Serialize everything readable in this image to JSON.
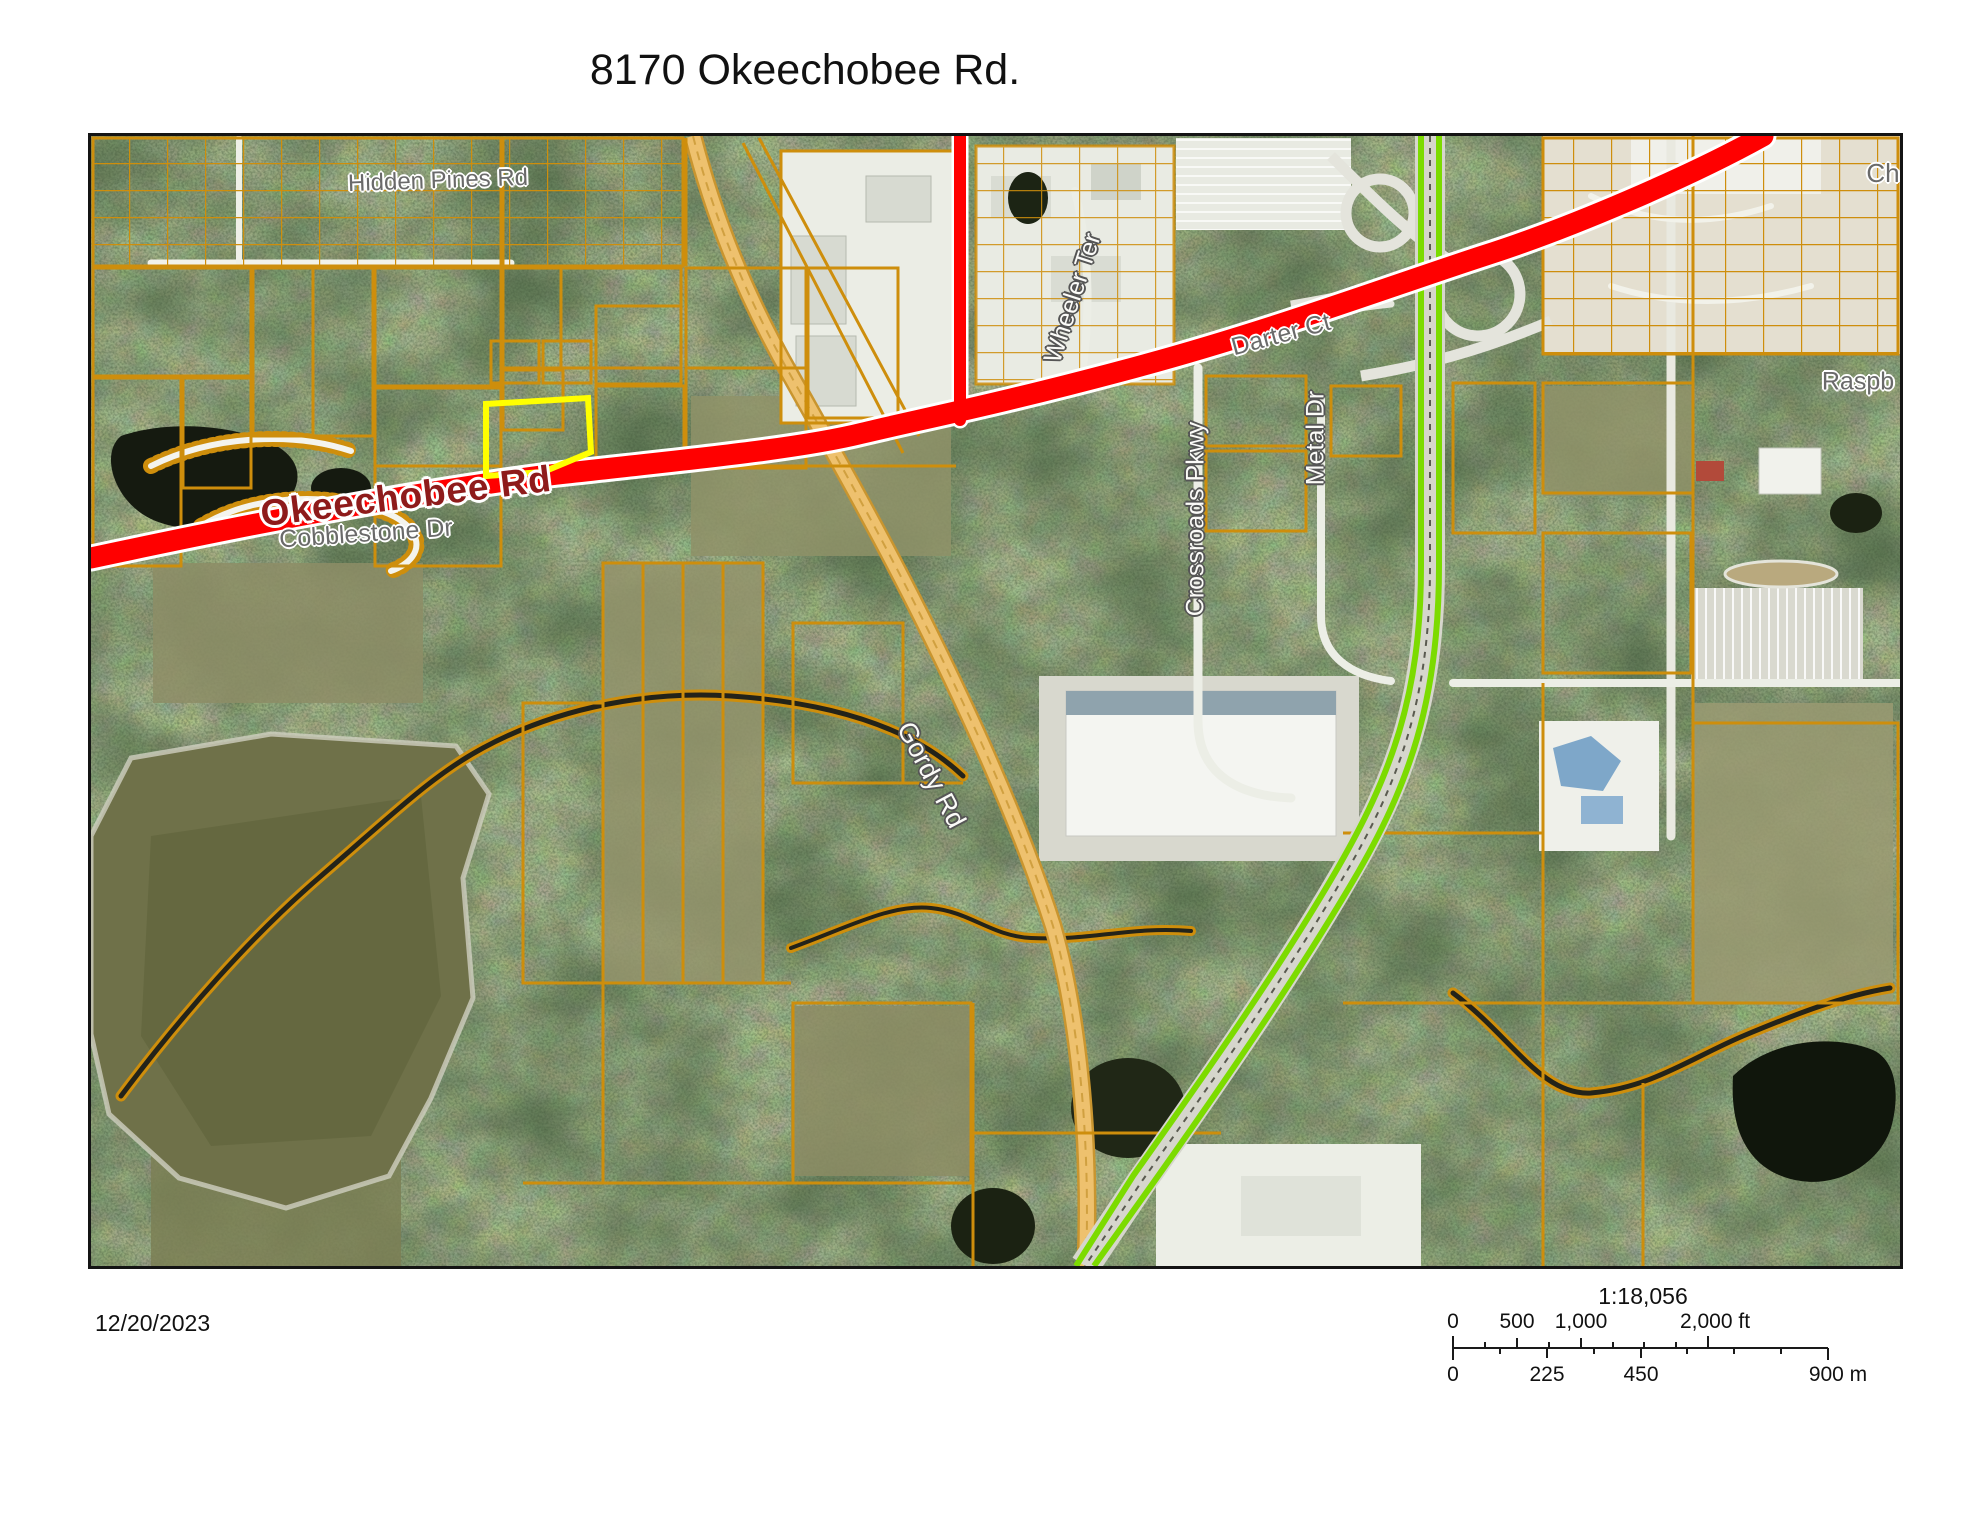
{
  "title": "8170 Okeechobee Rd.",
  "map": {
    "labels": {
      "hidden_pines": "Hidden Pines Rd",
      "okeechobee": "Okeechobee Rd",
      "cobblestone": "Cobblestone Dr",
      "wheeler": "Wheeler Ter",
      "darter": "Darter Ct",
      "crossroads": "Crossroads Pkwy",
      "metal": "Metal Dr",
      "gordy": "Gordy Rd",
      "raspberry": "Raspb",
      "ch": "Ch"
    },
    "colors": {
      "parcel_line": "#ce8e0c",
      "major_road": "#ff0000",
      "highway": "#7cdb00",
      "highlight_parcel": "#ffff00",
      "road_label_red": "#8e1b1b"
    }
  },
  "annotations": {
    "date": "12/20/2023"
  },
  "scalebar": {
    "ratio": "1:18,056",
    "feet_labels": [
      "0",
      "500",
      "1,000",
      "2,000 ft"
    ],
    "meter_labels": [
      "0",
      "225",
      "450",
      "900 m"
    ]
  }
}
